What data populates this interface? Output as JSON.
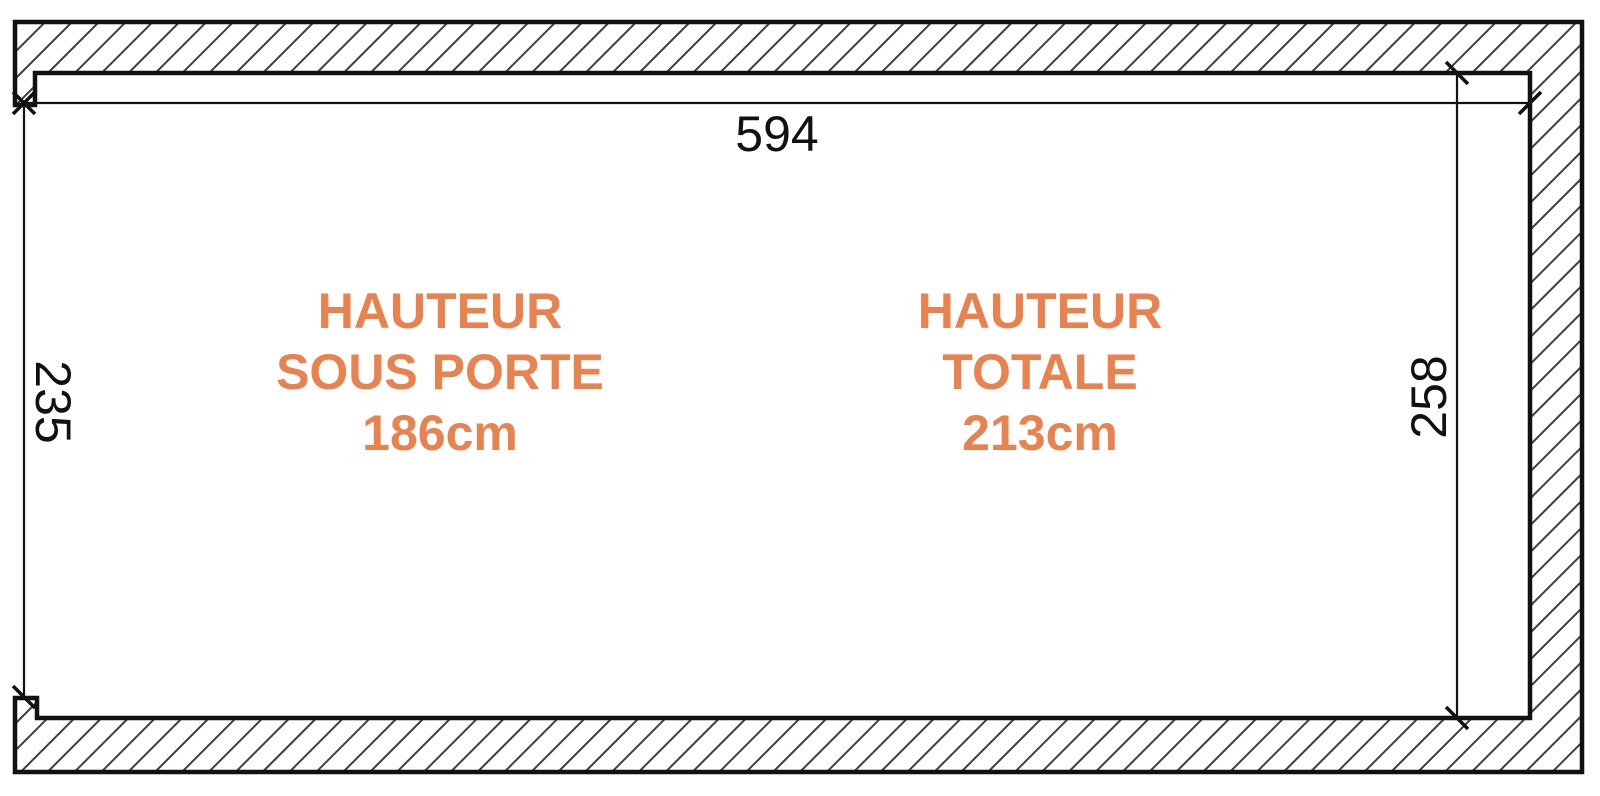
{
  "diagram": {
    "type": "architectural-section",
    "dimensions": {
      "top_width": "594",
      "left_height": "235",
      "right_height": "258"
    },
    "annotations": {
      "door_height": [
        "HAUTEUR",
        "SOUS PORTE",
        "186cm"
      ],
      "total_height": [
        "HAUTEUR",
        "TOTALE",
        "213cm"
      ]
    },
    "colors": {
      "annotation_orange": "#E8824E",
      "line_black": "#111111",
      "hatch_gray": "#3F3F3F",
      "background": "#FFFFFF"
    }
  }
}
